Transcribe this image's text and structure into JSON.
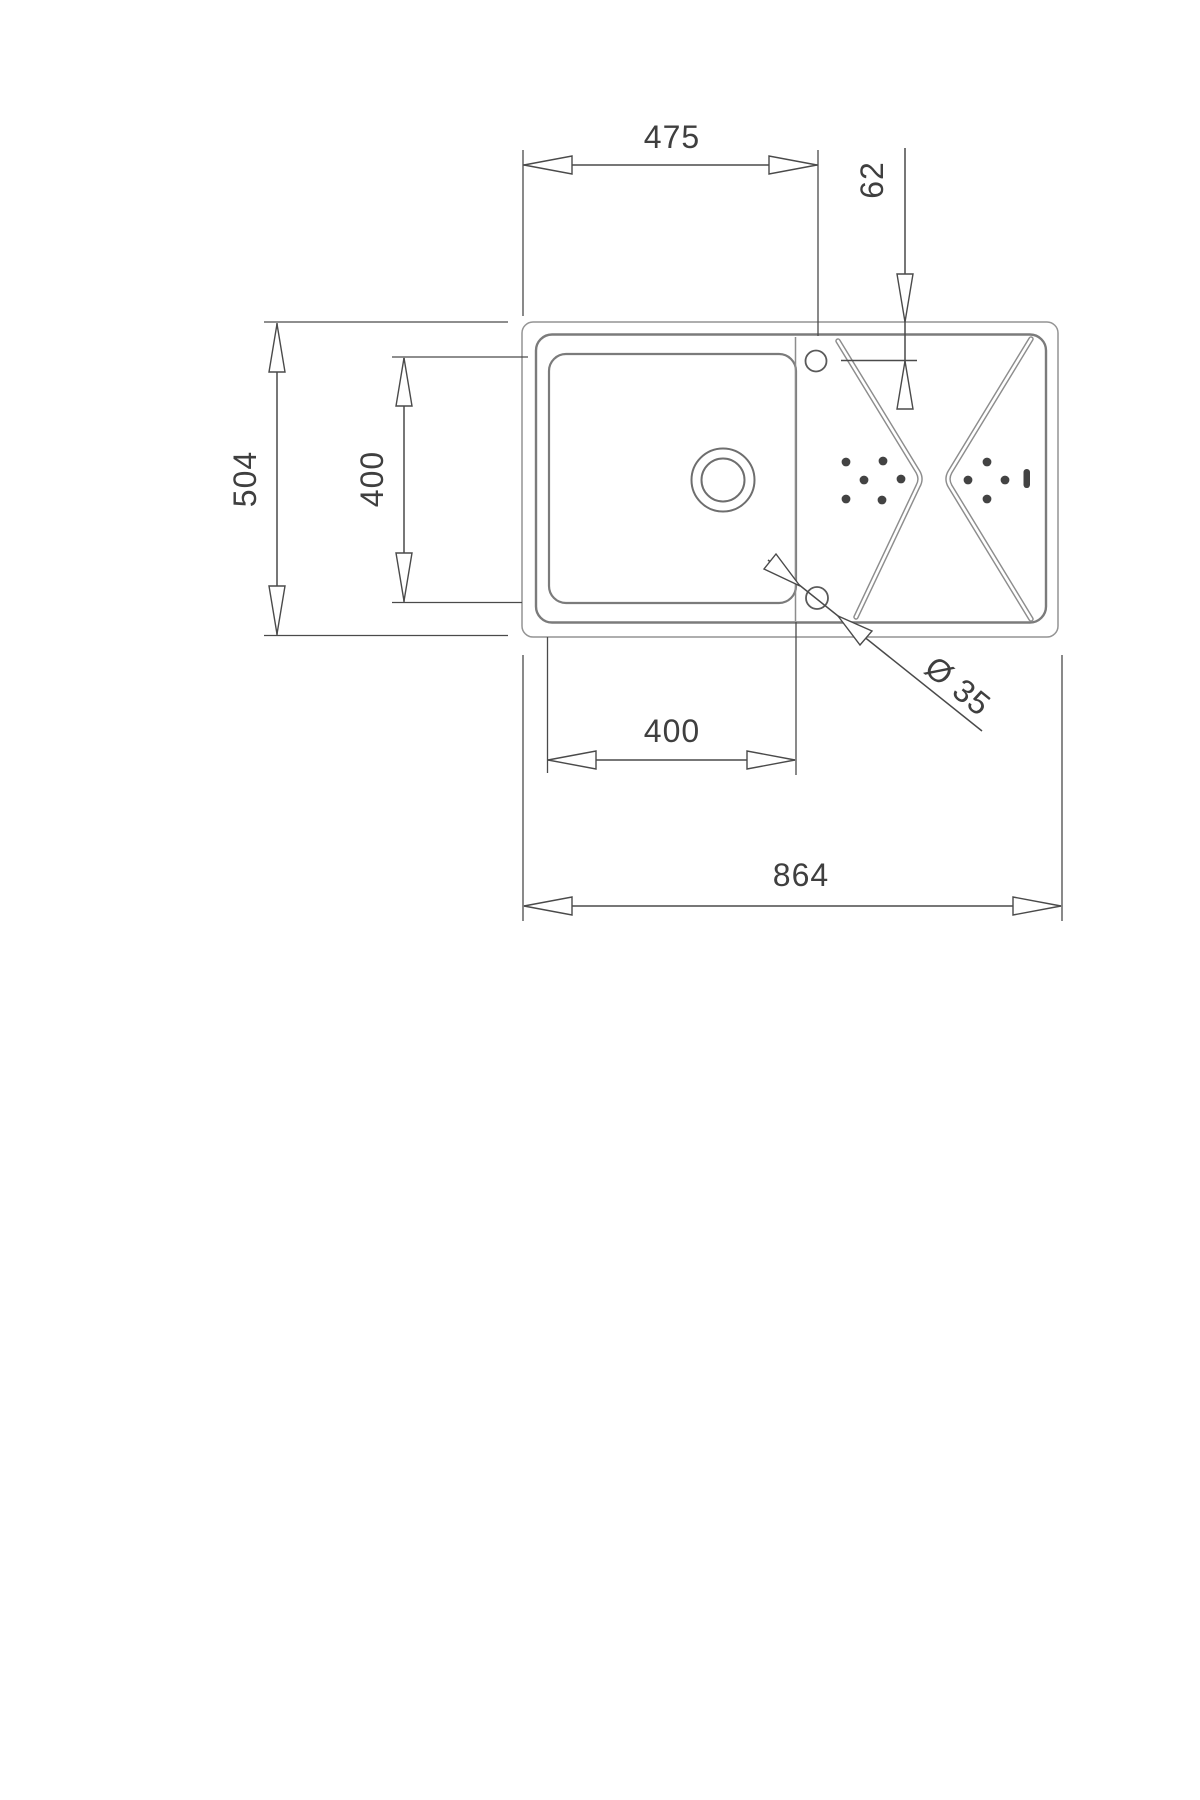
{
  "drawing": {
    "description": "technical-dimension-drawing-kitchen-sink-top-view",
    "background_color": "#ffffff",
    "sink_line_color": "#8d8d8d",
    "dimension_line_color": "#4a4a4a",
    "text_color": "#3f3f3f",
    "labels": {
      "top_width": "475",
      "tap_hole_offset": "62",
      "overall_depth": "504",
      "bowl_depth": "400",
      "bowl_width": "400",
      "overall_width": "864",
      "hole_diameter": "Ø 35"
    }
  }
}
